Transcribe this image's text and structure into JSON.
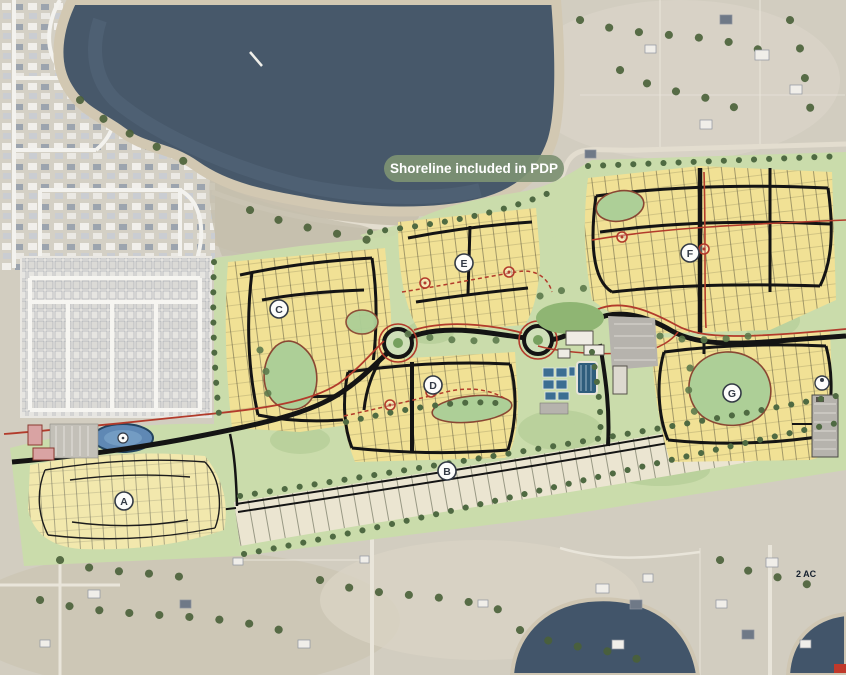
{
  "map": {
    "type": "master-planned-community-site-plan-over-aerial",
    "shoreline_label": "Shoreline included in PDP",
    "area_note": "2 AC",
    "parcels": [
      {
        "letter": "A"
      },
      {
        "letter": "B"
      },
      {
        "letter": "C"
      },
      {
        "letter": "D"
      },
      {
        "letter": "E"
      },
      {
        "letter": "F"
      },
      {
        "letter": "G"
      }
    ],
    "colors": {
      "water": "#47586a",
      "parcel_yellow": "#f1e195",
      "open_space_green": "#cadcab",
      "estate_beige": "#ebe5d1",
      "road": "#141414",
      "trail_red": "#b23b2b",
      "label_pill": "#7d9173"
    }
  }
}
